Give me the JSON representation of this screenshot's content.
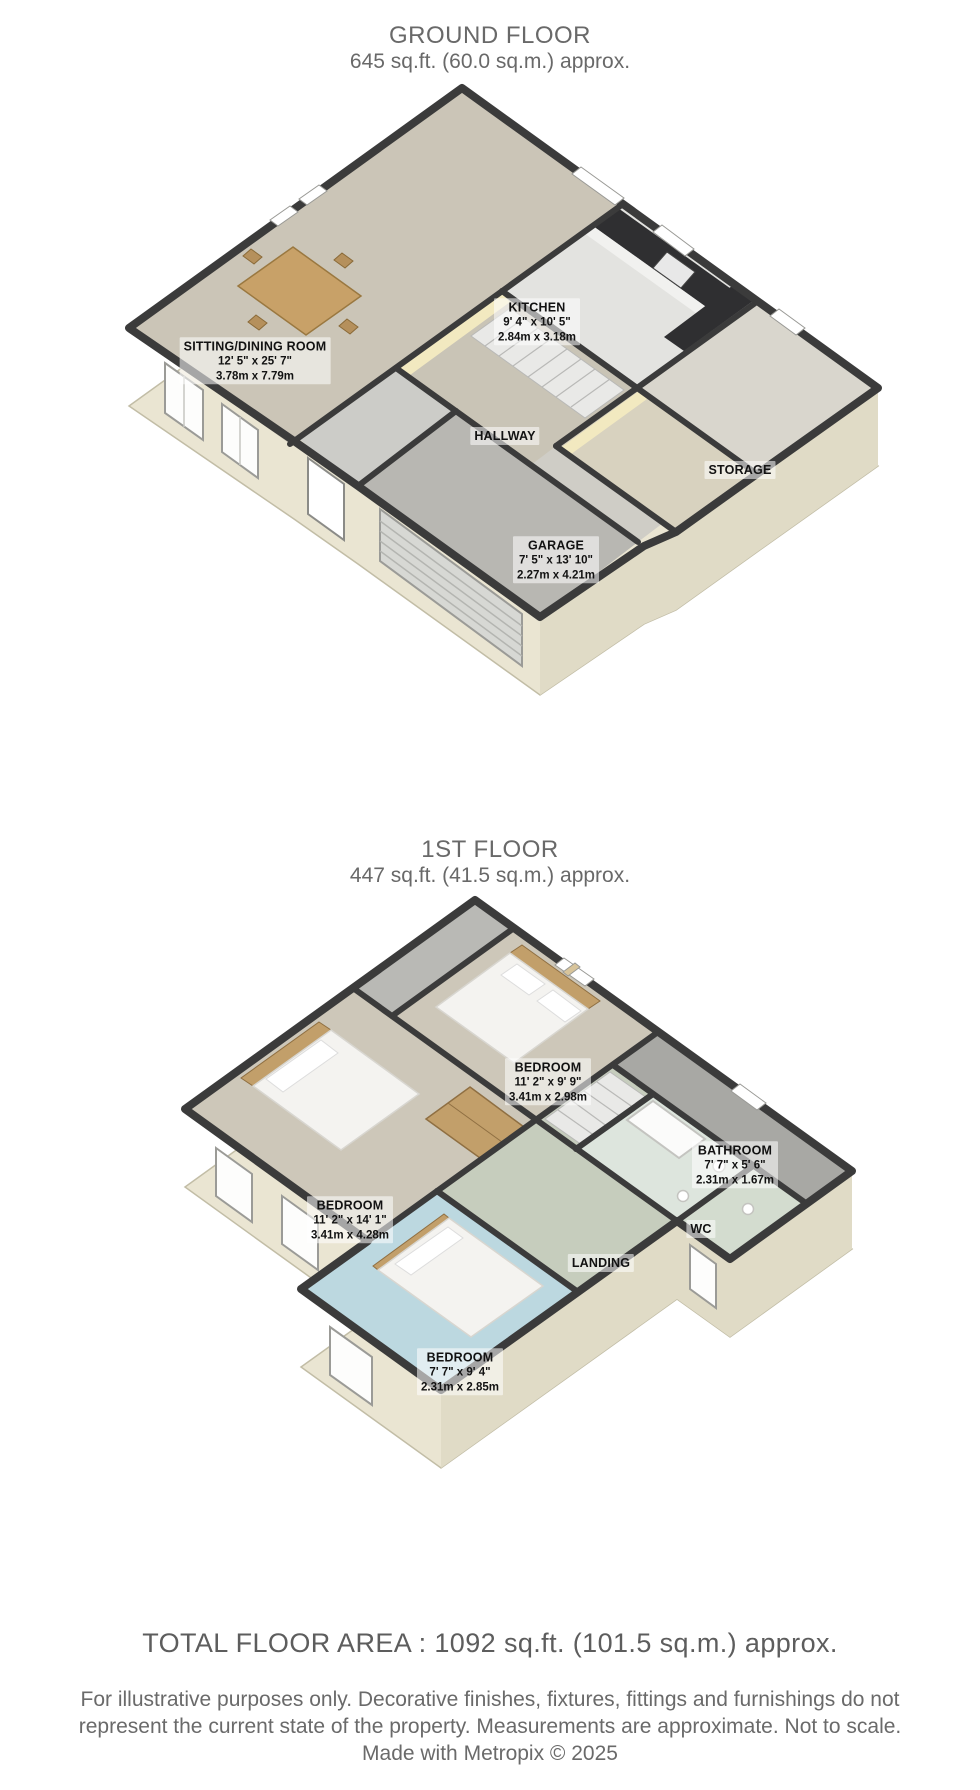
{
  "ground_floor": {
    "title": "GROUND FLOOR",
    "subtitle": "645 sq.ft. (60.0 sq.m.) approx.",
    "rooms": {
      "sitting": {
        "name": "SITTING/DINING ROOM",
        "imperial": "12' 5\" x 25' 7\"",
        "metric": "3.78m x 7.79m"
      },
      "kitchen": {
        "name": "KITCHEN",
        "imperial": "9' 4\" x 10' 5\"",
        "metric": "2.84m x 3.18m"
      },
      "hallway": {
        "name": "HALLWAY"
      },
      "storage": {
        "name": "STORAGE"
      },
      "garage": {
        "name": "GARAGE",
        "imperial": "7' 5\" x 13' 10\"",
        "metric": "2.27m x 4.21m"
      }
    }
  },
  "first_floor": {
    "title": "1ST FLOOR",
    "subtitle": "447 sq.ft. (41.5 sq.m.) approx.",
    "rooms": {
      "bedroom1": {
        "name": "BEDROOM",
        "imperial": "11' 2\" x 9' 9\"",
        "metric": "3.41m x 2.98m"
      },
      "bathroom": {
        "name": "BATHROOM",
        "imperial": "7' 7\" x 5' 6\"",
        "metric": "2.31m x 1.67m"
      },
      "bedroom2": {
        "name": "BEDROOM",
        "imperial": "11' 2\" x 14' 1\"",
        "metric": "3.41m x 4.28m"
      },
      "wc": {
        "name": "WC"
      },
      "landing": {
        "name": "LANDING"
      },
      "bedroom3": {
        "name": "BEDROOM",
        "imperial": "7' 7\" x 9' 4\"",
        "metric": "2.31m x 2.85m"
      }
    }
  },
  "footer": {
    "total": "TOTAL FLOOR AREA : 1092 sq.ft. (101.5 sq.m.) approx.",
    "disclaimer_line1": "For illustrative purposes only. Decorative finishes, fixtures, fittings and furnishings do not",
    "disclaimer_line2": "represent the current state of the property. Measurements are approximate. Not to scale.",
    "credit": "Made with Metropix © 2025"
  },
  "colors": {
    "wall_dark": "#3b3b3b",
    "exterior_wall_cream": "#eae5d2",
    "carpet_beige": "#cbc5b7",
    "kitchen_floor": "#e3e3e0",
    "garage_concrete": "#b8b7b2",
    "blue_carpet": "#bcd8e0",
    "landing_green": "#c6cdbd",
    "eaves_gray": "#a8a8a4",
    "wood": "#c29f6a",
    "label_text": "#121212",
    "title_gray": "#696969"
  }
}
